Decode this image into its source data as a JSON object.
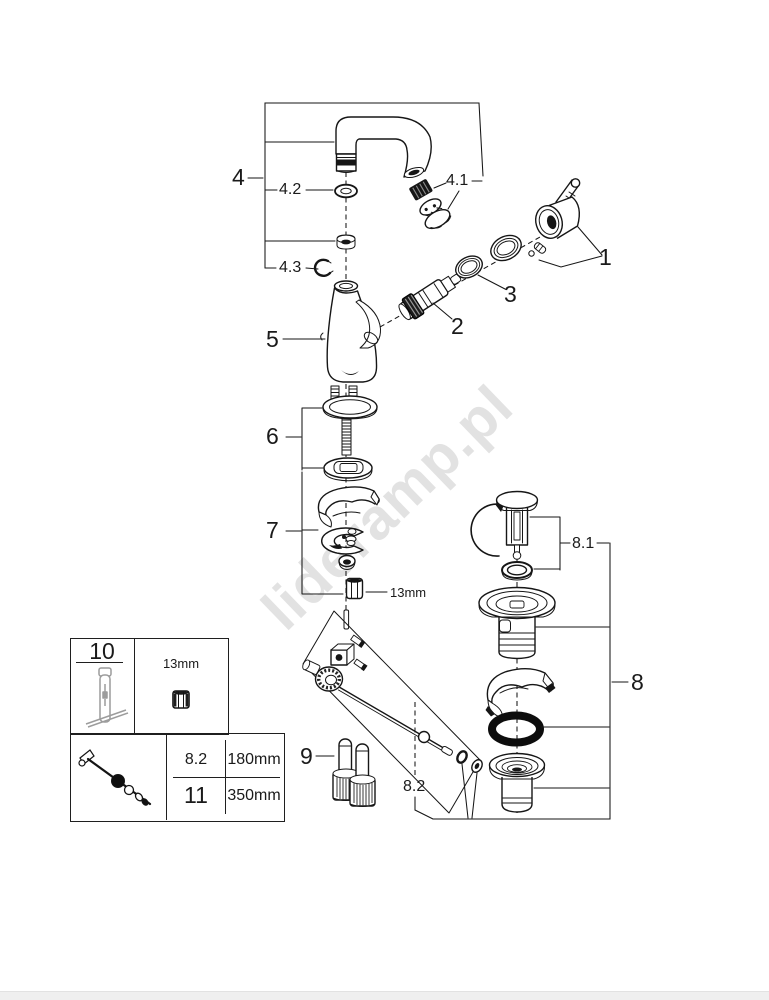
{
  "watermark": {
    "text": "lideramp.pl"
  },
  "labels": {
    "part_1": "1",
    "part_2": "2",
    "part_3": "3",
    "part_4": "4",
    "part_4_1": "4.1",
    "part_4_2": "4.2",
    "part_4_3": "4.3",
    "part_5": "5",
    "part_6": "6",
    "part_7": "7",
    "part_8": "8",
    "part_8_1": "8.1",
    "part_8_2": "8.2",
    "part_9": "9",
    "wrench_size": "13mm"
  },
  "legend": {
    "tool_number": "10",
    "nut_size": "13mm",
    "rows": [
      {
        "part": "8.2",
        "length": "180mm"
      },
      {
        "part": "11",
        "length": "350mm"
      }
    ]
  }
}
